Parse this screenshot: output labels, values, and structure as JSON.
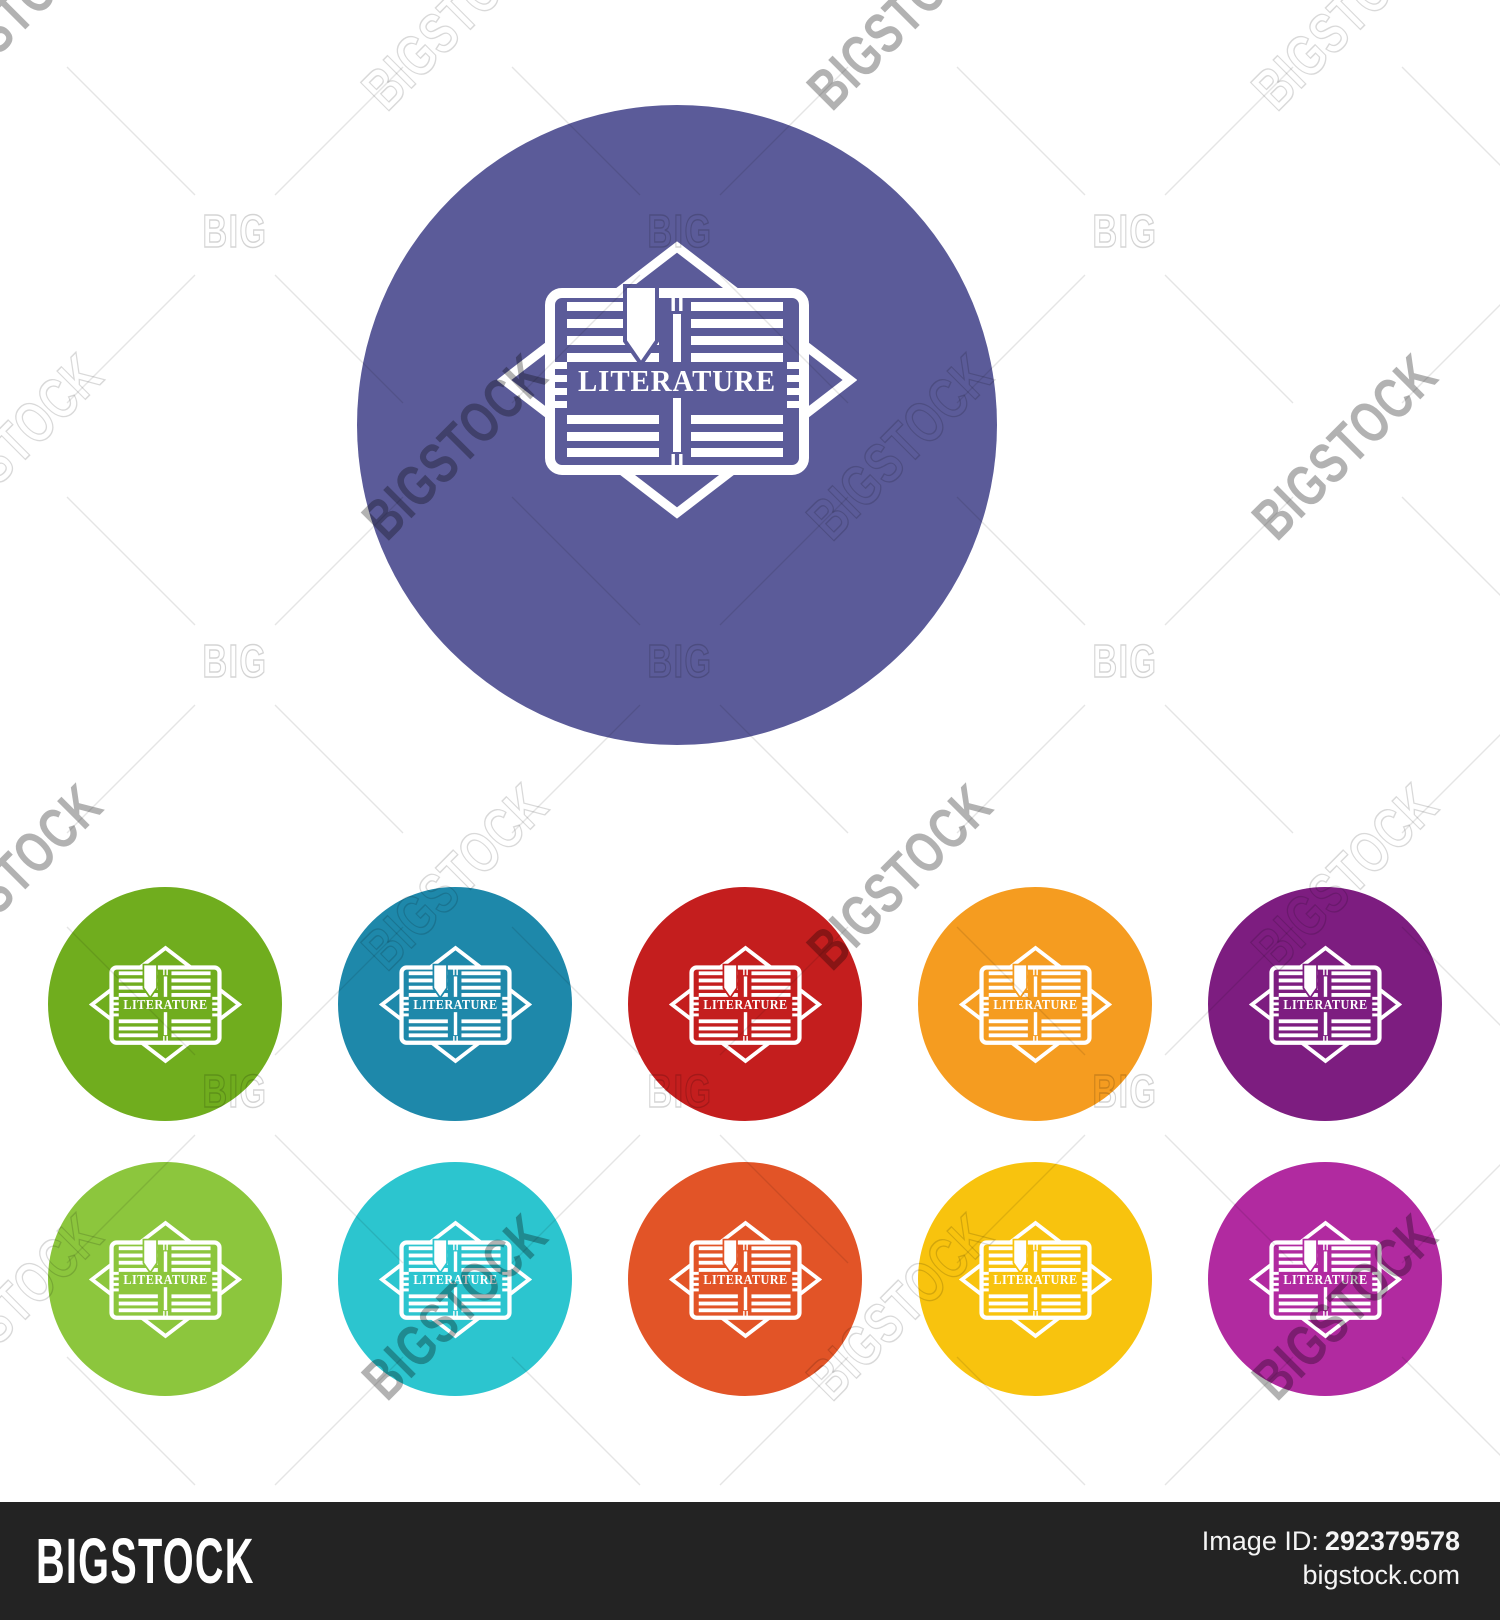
{
  "icon": {
    "label": "LITERATURE",
    "description": "open-book-with-bookmark-and-diamond-emblem"
  },
  "watermark": {
    "big": "BIG",
    "bigstock": "BIGSTOCK"
  },
  "footer": {
    "brand": "BIGSTOCK",
    "image_id_label": "Image ID:",
    "image_id_value": "292379578",
    "site": "bigstock.com",
    "bar_color": "#232323"
  },
  "circles": [
    {
      "name": "main-slate-purple",
      "color": "#5b5b99"
    },
    {
      "name": "green",
      "color": "#70ad1e"
    },
    {
      "name": "blue",
      "color": "#1e88aa"
    },
    {
      "name": "red",
      "color": "#c41e1e"
    },
    {
      "name": "orange",
      "color": "#f59c20"
    },
    {
      "name": "dark-purple",
      "color": "#7d1d80"
    },
    {
      "name": "light-green",
      "color": "#8cc63d"
    },
    {
      "name": "cyan",
      "color": "#2cc5cf"
    },
    {
      "name": "orange-red",
      "color": "#e25427"
    },
    {
      "name": "yellow",
      "color": "#f8c30e"
    },
    {
      "name": "magenta",
      "color": "#b12aa0"
    }
  ]
}
